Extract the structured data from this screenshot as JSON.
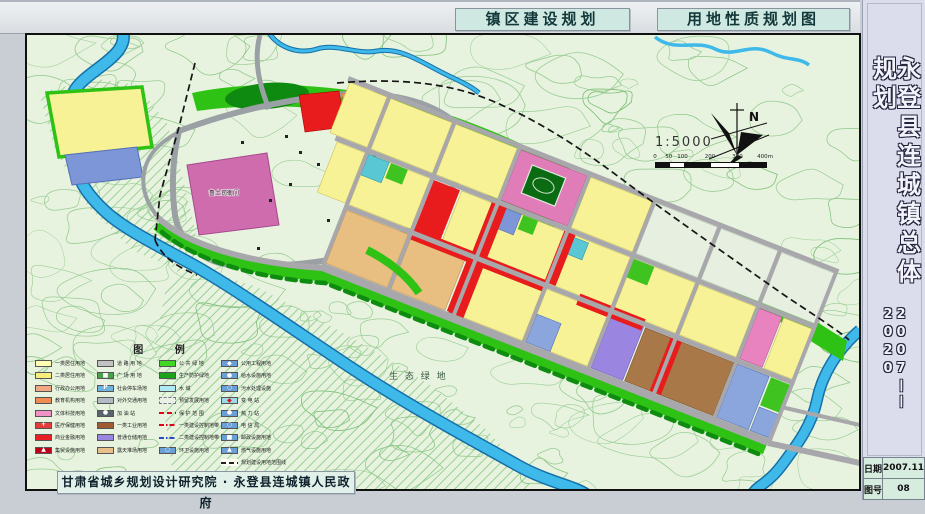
{
  "header": {
    "title_left": "镇区建设规划",
    "title_right": "用地性质规划图"
  },
  "sidebar": {
    "title": "永登县连城镇总体规划",
    "years_start": "2007",
    "years_dash": "——",
    "years_end": "2020"
  },
  "info_table": {
    "rows": [
      {
        "label": "日期",
        "value": "2007.11"
      },
      {
        "label": "图号",
        "value": "08"
      }
    ]
  },
  "footer": {
    "org": "甘肃省城乡规划设计研究院 · 永登县连城镇人民政府"
  },
  "map": {
    "north": "N",
    "scale": "1:5000",
    "scale_ticks": [
      "0",
      "50",
      "100",
      "200",
      "300",
      "400m"
    ],
    "labels": {
      "yamen": "鲁土司衙门",
      "eco": "生 态 绿 地"
    },
    "colors": {
      "residential1": "#ffffb4",
      "residential2": "#f8f296",
      "admin": "#f2a883",
      "education": "#ee8c53",
      "culture": "#ef93c5",
      "commerce": "#e81c1c",
      "industry1": "#a87848",
      "warehouse": "#9a86e0",
      "stockyard": "#e8bf80",
      "public_green": "#2ec214",
      "protective_green": "#128a0e",
      "water": "#3fb9ea",
      "utility_blue": "#7d96d8",
      "road_gray": "#a8a8ac"
    }
  },
  "legend": {
    "title": "图    例",
    "columns": [
      {
        "items": [
          {
            "label": "一类居住用地",
            "sw": "#ffffb4"
          },
          {
            "label": "二类居住用地",
            "sw": "#f7ee7f"
          },
          {
            "label": "行政办公用地",
            "sw": "#f2a883"
          },
          {
            "label": "教育机构用地",
            "sw": "#ee8c53"
          },
          {
            "label": "文体科技用地",
            "sw": "#ef93c5"
          },
          {
            "label": "医疗保健用地",
            "sw": "#e43c38",
            "icon": "+",
            "ic": "#ffffff"
          },
          {
            "label": "商业金融用地",
            "sw": "#e81f25"
          },
          {
            "label": "集贸设施用地",
            "sw": "#bf0019",
            "icon": "▲",
            "ic": "#ffffff"
          }
        ]
      },
      {
        "items": [
          {
            "label": "道 路 用 地",
            "sw": "#c2c2c2"
          },
          {
            "label": "广 场 用 地",
            "sw": "#49a24b",
            "icon": "■",
            "ic": "#ffffff"
          },
          {
            "label": "社会停车场地",
            "sw": "#6fb4dd",
            "icon": "P",
            "ic": "#ffffff"
          },
          {
            "label": "对外交通用地",
            "sw": "#b2bac4"
          },
          {
            "label": "加  油  站",
            "sw": "#5a6470",
            "icon": "●",
            "ic": "#ffffff"
          },
          {
            "label": "一类工业用地",
            "sw": "#a05a32"
          },
          {
            "label": "普通仓储用地",
            "sw": "#9a86e0"
          },
          {
            "label": "露天堆场用地",
            "sw": "#e7c189"
          }
        ]
      },
      {
        "items": [
          {
            "label": "公 共 绿 地",
            "sw": "#3fd924"
          },
          {
            "label": "生产防护绿地",
            "sw": "#1ba31b"
          },
          {
            "label": "水       域",
            "sw": "#aeeaf2"
          },
          {
            "label": "预留发展用地",
            "sw": "#e9f2e4",
            "dashedBorder": true
          },
          {
            "label": "保 护 范 围",
            "line": "red-dash"
          },
          {
            "label": "一类建设控制地带",
            "line": "red-dashdot"
          },
          {
            "label": "二类建设控制地带",
            "line": "blue-dashdot"
          },
          {
            "label": "环卫设施用地",
            "sw": "#6a9fd8",
            "icon": "○",
            "ic": "#ffffff"
          }
        ]
      },
      {
        "items": [
          {
            "label": "公用工程用地",
            "sw": "#6a9fd8",
            "icon": "◆",
            "ic": "#ffffff"
          },
          {
            "label": "给水设施用地",
            "sw": "#6a9fd8",
            "icon": "●",
            "ic": "#ffffff"
          },
          {
            "label": "污水处理设施",
            "sw": "#6a9fd8",
            "icon": "○",
            "ic": "#ffffff"
          },
          {
            "label": "变  电  站",
            "sw": "#9fd8ea",
            "icon": "◆",
            "ic": "#d01818"
          },
          {
            "label": "热  力  站",
            "sw": "#6a9fd8",
            "icon": "●",
            "ic": "#ffffff"
          },
          {
            "label": "电  信  局",
            "sw": "#6a9fd8",
            "icon": "○",
            "ic": "#ffffff"
          },
          {
            "label": "邮政设施用地",
            "sw": "#6a9fd8",
            "icon": "■",
            "ic": "#ffffff"
          },
          {
            "label": "燃气设施用地",
            "sw": "#6a9fd8",
            "icon": "▲",
            "ic": "#ffffff"
          },
          {
            "label": "规划建设用地范围线",
            "line": "black-dash"
          }
        ]
      }
    ]
  }
}
